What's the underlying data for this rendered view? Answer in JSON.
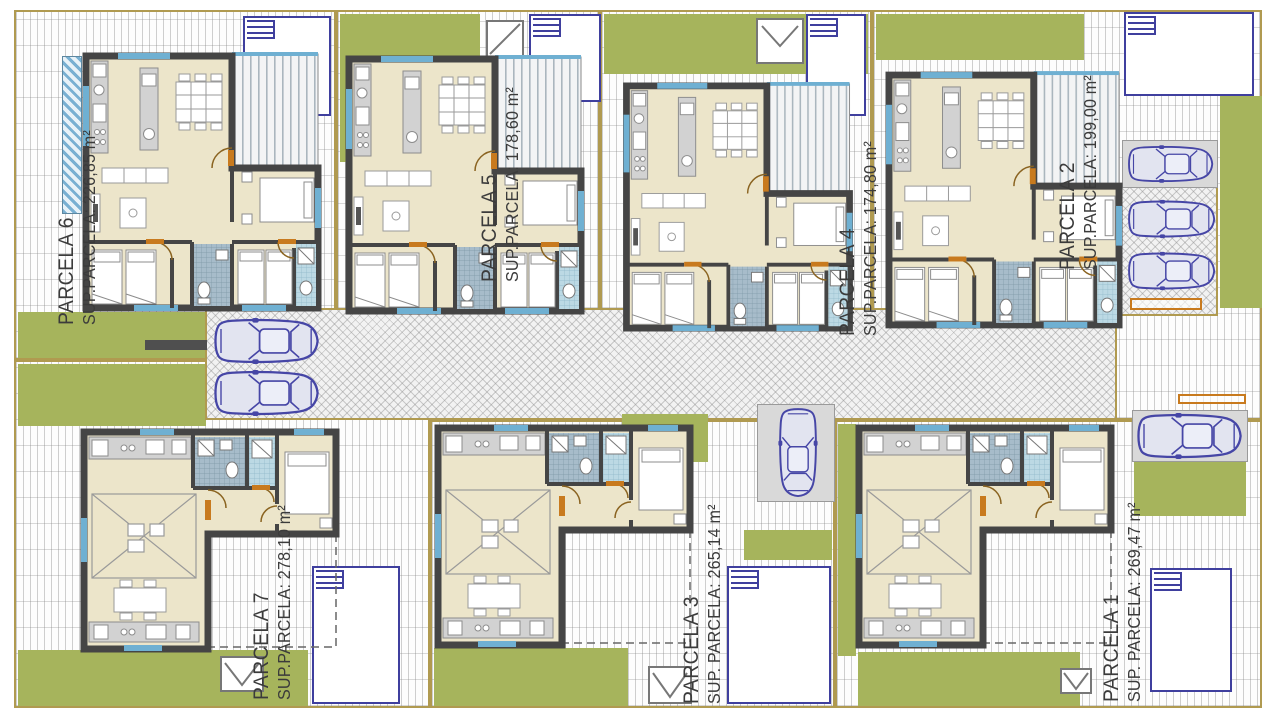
{
  "plan": {
    "parcels": [
      {
        "key": "p6",
        "name": "PARCELA 6",
        "area": "SUP.PARCELA: 226,85 m²"
      },
      {
        "key": "p5",
        "name": "PARCELA 5",
        "area": "SUP.PARCELA: 178,60 m²"
      },
      {
        "key": "p4",
        "name": "PARCELA 4",
        "area": "SUP.PARCELA: 174,80 m²"
      },
      {
        "key": "p2",
        "name": "PARCELA 2",
        "area": "SUP.PARCELA: 199,00 m²"
      },
      {
        "key": "p7",
        "name": "PARCELA 7",
        "area": "SUP.PARCELA: 278,10 m²"
      },
      {
        "key": "p3",
        "name": "PARCELA 3",
        "area": "SUP. PARCELA: 265,14 m²"
      },
      {
        "key": "p1",
        "name": "PARCELA 1",
        "area": "SUP. PARCELA: 269,47 m²"
      }
    ],
    "colors": {
      "grass": "#a6b45c",
      "wall": "#454545",
      "floor": "#ece5ca",
      "pool_border": "#3f3f9e",
      "car_outline": "#4646a6",
      "boundary": "#b09a50",
      "bath_tile": "#a7bcca",
      "glass": "#6fb0d2",
      "accent": "#c87a1e"
    }
  }
}
